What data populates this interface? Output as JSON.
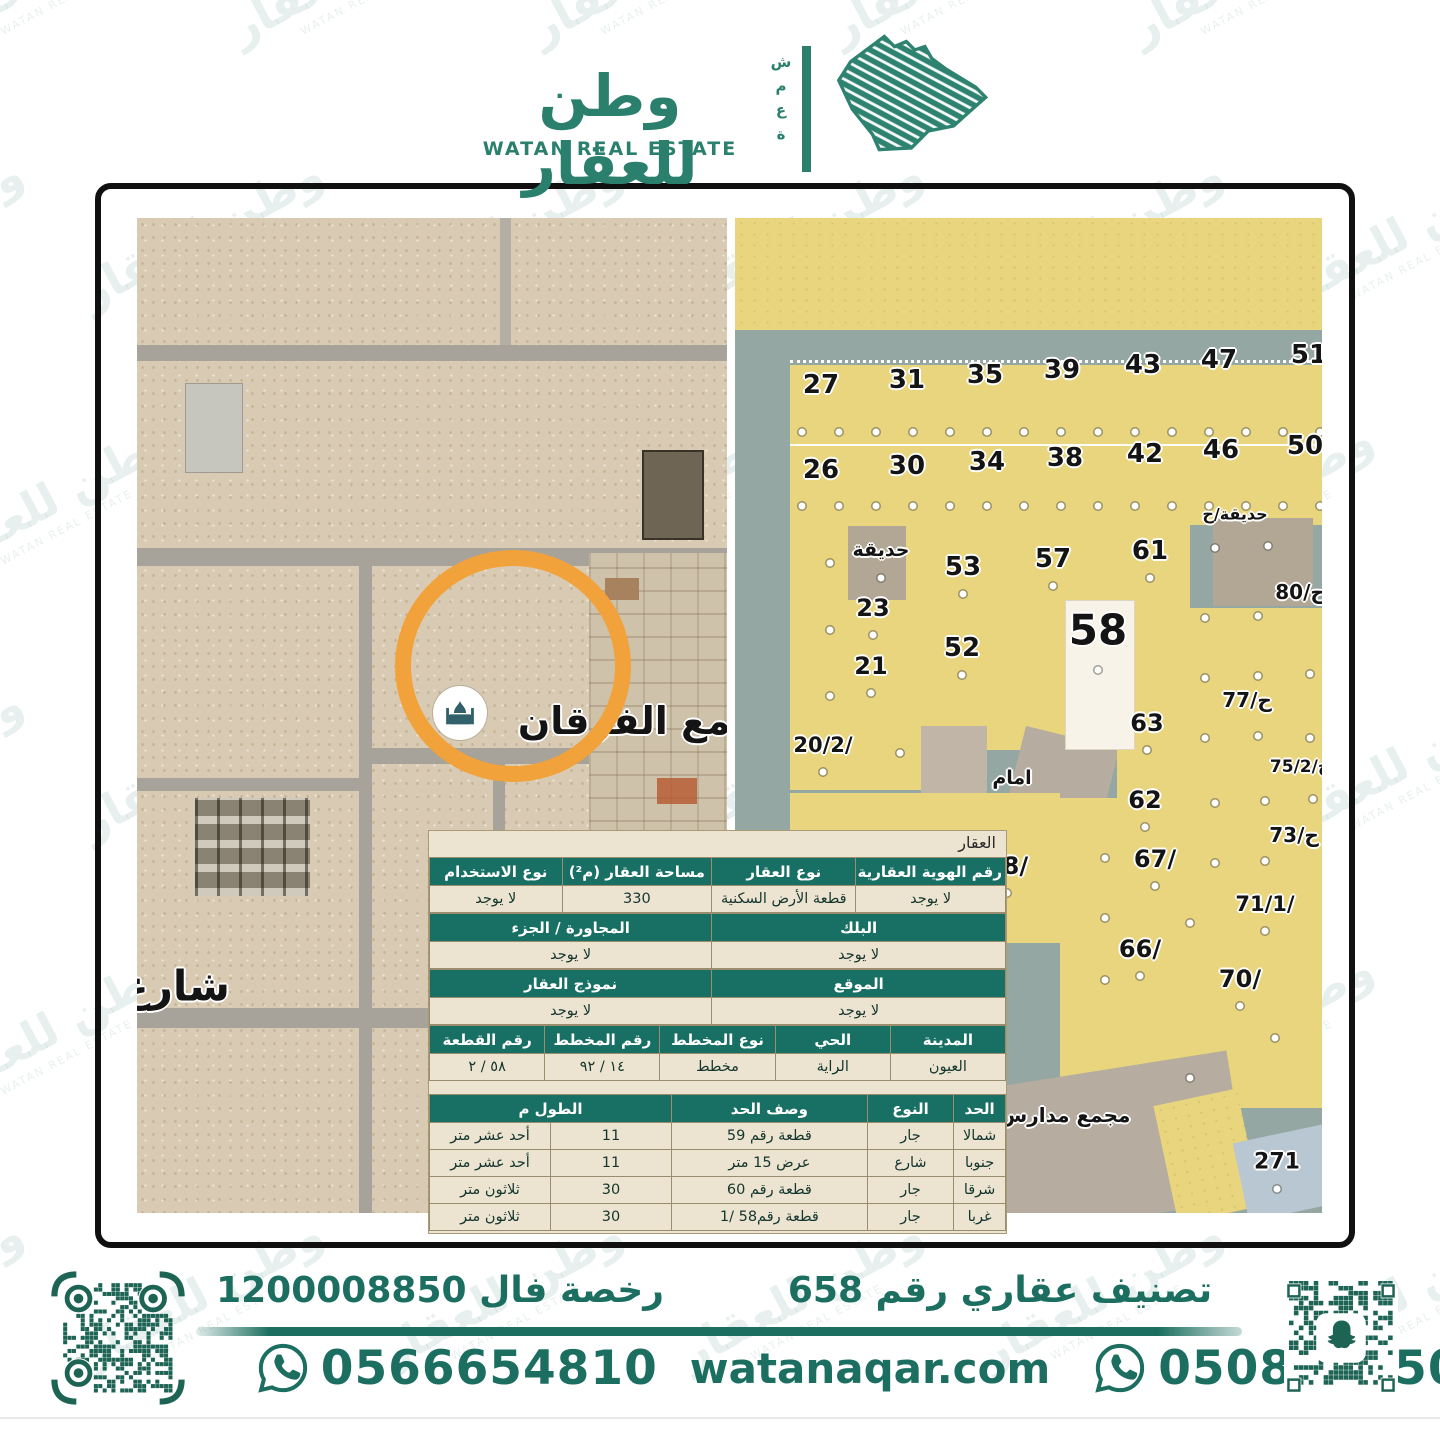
{
  "header": {
    "brand_ar": "وطن للعقار",
    "brand_en": "WATAN REAL ESTATE",
    "side_word": "ش\nم\nع\nة"
  },
  "colors": {
    "brand_green": "#2b7f6d",
    "footer_green": "#1c6f60",
    "table_header_green": "#177063",
    "table_beige": "#ece3d0",
    "highlight_orange": "#f1a23b",
    "plot_yellow": "#e8d57d",
    "road_gray": "#95a7a3",
    "sand": "#d9cbb3"
  },
  "sat_labels": [
    {
      "t": "شارع",
      "x": 38,
      "y": 768,
      "fs": 42
    },
    {
      "t": "جامع الفرقان",
      "x": 508,
      "y": 503,
      "fs": 38
    }
  ],
  "parcel_labels": [
    {
      "t": "27",
      "x": 86,
      "y": 167,
      "fs": 26
    },
    {
      "t": "31",
      "x": 172,
      "y": 162,
      "fs": 26
    },
    {
      "t": "35",
      "x": 250,
      "y": 157,
      "fs": 26
    },
    {
      "t": "39",
      "x": 327,
      "y": 152,
      "fs": 26
    },
    {
      "t": "43",
      "x": 408,
      "y": 147,
      "fs": 26
    },
    {
      "t": "47",
      "x": 484,
      "y": 142,
      "fs": 26
    },
    {
      "t": "51",
      "x": 574,
      "y": 137,
      "fs": 26
    },
    {
      "t": "26",
      "x": 86,
      "y": 252,
      "fs": 26
    },
    {
      "t": "30",
      "x": 172,
      "y": 248,
      "fs": 26
    },
    {
      "t": "34",
      "x": 252,
      "y": 244,
      "fs": 26
    },
    {
      "t": "38",
      "x": 330,
      "y": 240,
      "fs": 26
    },
    {
      "t": "42",
      "x": 410,
      "y": 236,
      "fs": 26
    },
    {
      "t": "46",
      "x": 486,
      "y": 232,
      "fs": 26
    },
    {
      "t": "50",
      "x": 570,
      "y": 228,
      "fs": 26
    },
    {
      "t": "حديقة",
      "x": 146,
      "y": 332,
      "fs": 19
    },
    {
      "t": "23",
      "x": 138,
      "y": 390,
      "fs": 24
    },
    {
      "t": "21",
      "x": 136,
      "y": 448,
      "fs": 24
    },
    {
      "t": "20/2/",
      "x": 88,
      "y": 527,
      "fs": 21
    },
    {
      "t": "53",
      "x": 228,
      "y": 349,
      "fs": 26
    },
    {
      "t": "57",
      "x": 318,
      "y": 341,
      "fs": 26
    },
    {
      "t": "61",
      "x": 415,
      "y": 333,
      "fs": 26
    },
    {
      "t": "52",
      "x": 227,
      "y": 430,
      "fs": 26
    },
    {
      "t": "58",
      "x": 363,
      "y": 412,
      "fs": 42
    },
    {
      "t": "63",
      "x": 412,
      "y": 505,
      "fs": 24
    },
    {
      "t": "62",
      "x": 410,
      "y": 582,
      "fs": 24
    },
    {
      "t": "امام",
      "x": 277,
      "y": 560,
      "fs": 19
    },
    {
      "t": "حديقة/ح",
      "x": 500,
      "y": 296,
      "fs": 16
    },
    {
      "t": "ح/80",
      "x": 565,
      "y": 374,
      "fs": 20
    },
    {
      "t": "ح/77",
      "x": 512,
      "y": 482,
      "fs": 20
    },
    {
      "t": "ح/75/2",
      "x": 565,
      "y": 549,
      "fs": 17
    },
    {
      "t": "ح/73",
      "x": 559,
      "y": 617,
      "fs": 20
    },
    {
      "t": "10",
      "x": 103,
      "y": 636,
      "fs": 24
    },
    {
      "t": "14",
      "x": 184,
      "y": 641,
      "fs": 24
    },
    {
      "t": "18/",
      "x": 272,
      "y": 648,
      "fs": 24
    },
    {
      "t": "67/",
      "x": 420,
      "y": 641,
      "fs": 24
    },
    {
      "t": "71/1/",
      "x": 530,
      "y": 686,
      "fs": 21
    },
    {
      "t": "66/",
      "x": 405,
      "y": 731,
      "fs": 24
    },
    {
      "t": "70/",
      "x": 505,
      "y": 761,
      "fs": 24
    },
    {
      "t": "271",
      "x": 542,
      "y": 944,
      "fs": 22
    },
    {
      "t": "مجمع مدارس",
      "x": 330,
      "y": 897,
      "fs": 20
    }
  ],
  "tables": {
    "title": "العقار",
    "t1_cols": [
      "رقم الهوية العقارية",
      "نوع العقار",
      "مساحة العقار (م²)",
      "نوع الاستخدام"
    ],
    "t1_vals": [
      "لا يوجد",
      "قطعة الأرض السكنية",
      "330",
      "لا يوجد"
    ],
    "t2_cols": [
      "البلك",
      "المجاورة / الجزء"
    ],
    "t2_vals": [
      "لا يوجد",
      "لا يوجد"
    ],
    "t3_cols": [
      "الموقع",
      "نموذج العقار"
    ],
    "t3_vals": [
      "لا يوجد",
      "لا يوجد"
    ],
    "t4_cols": [
      "المدينة",
      "الحي",
      "نوع المخطط",
      "رقم المخطط",
      "رقم القطعة"
    ],
    "t4_vals": [
      "العيون",
      "الراية",
      "مخطط",
      "١٤ / ٩٢",
      "٥٨ / ٢"
    ],
    "b_cols": [
      "الحد",
      "النوع",
      "وصف الحد",
      "الطول م"
    ],
    "b_rows": [
      [
        "شمالا",
        "جار",
        "قطعة رقم 59",
        "11",
        "أحد عشر متر"
      ],
      [
        "جنوبا",
        "شارع",
        "عرض 15 متر",
        "11",
        "أحد عشر متر"
      ],
      [
        "شرقا",
        "جار",
        "قطعة رقم 60",
        "30",
        "ثلاثون متر"
      ],
      [
        "غربا",
        "جار",
        "قطعة رقم58 /1",
        "30",
        "ثلاثون متر"
      ]
    ]
  },
  "footer": {
    "license": "رخصة فال 1200008850",
    "classification": "تصنيف عقاري رقم 658",
    "phone_left": "0566654810",
    "website": "watanaqar.com",
    "phone_right": "0508505505"
  },
  "watermark": {
    "ar": "وطن للعقار",
    "en": "WATAN REAL ESTATE"
  }
}
